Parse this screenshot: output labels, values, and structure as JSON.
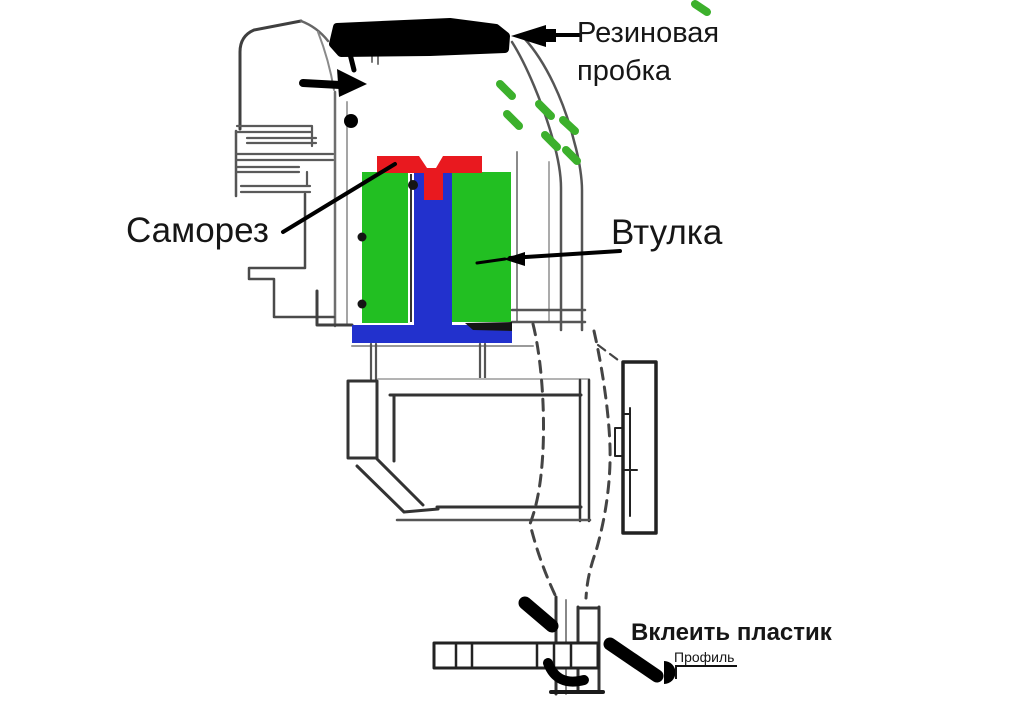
{
  "callouts": {
    "rubber_plug": {
      "label": "Резиновая пробка"
    },
    "screw": {
      "label": "Саморез"
    },
    "bushing": {
      "label": "Втулка"
    },
    "glue_plastic": {
      "label": "Вклеить пластик"
    },
    "profile": {
      "label": "Профиль"
    }
  },
  "colors": {
    "bushing_green": "#22bf22",
    "screw_shaft_blue": "#2231cd",
    "screw_head_red": "#e9191f",
    "marker_black": "#000000",
    "glue_dash_green": "#3cb02c"
  }
}
